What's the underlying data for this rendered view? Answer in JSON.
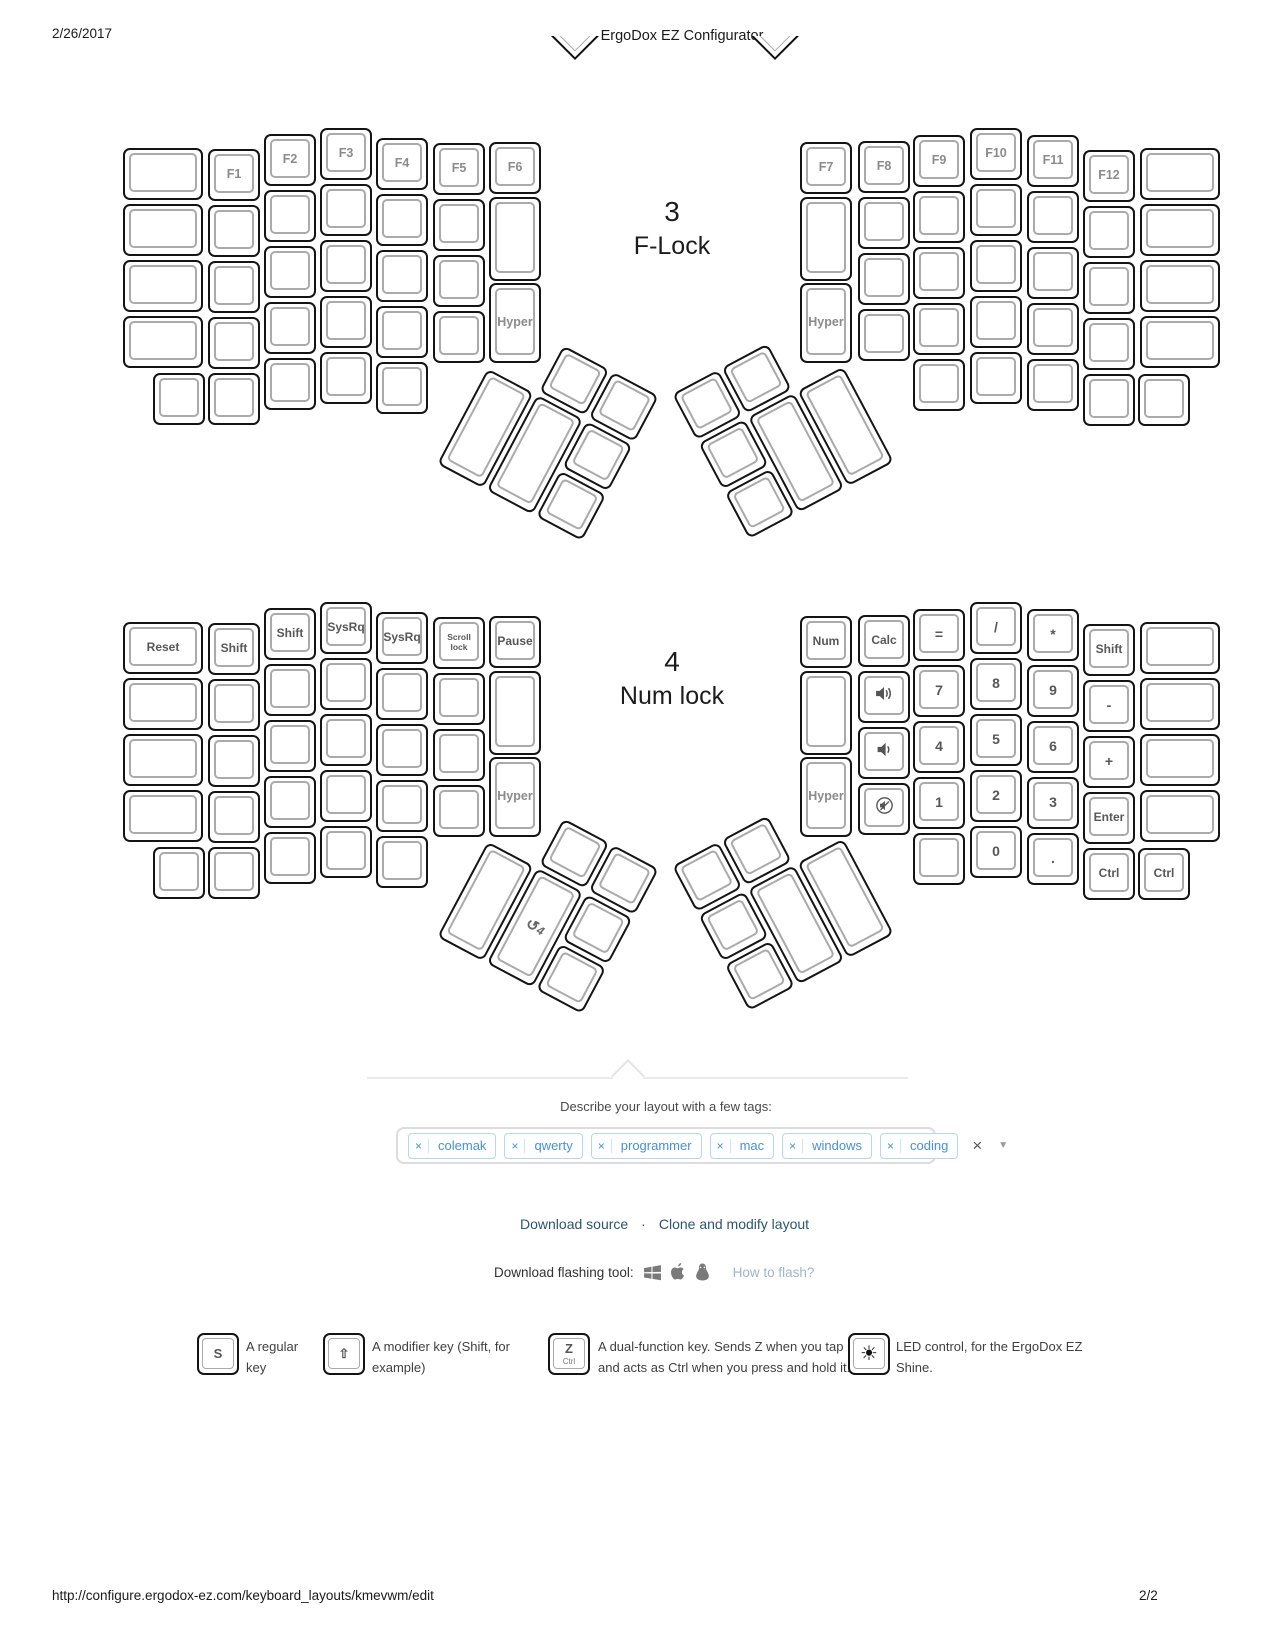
{
  "page": {
    "header_date": "2/26/2017",
    "header_title": "ErgoDox EZ Configurator",
    "footer_url": "http://configure.ergodox-ez.com/keyboard_layouts/kmevwm/edit",
    "footer_page": "2/2"
  },
  "colors": {
    "tag_text": "#4a90d2",
    "tag_border": "#b9d5ef",
    "link": "#2e5570",
    "muted_link": "#9fb5c8",
    "key_border": "#141414",
    "keytop_border": "#aaaaaa",
    "key_label": "#575757"
  },
  "thumb_toggle": {
    "glyph": "↺",
    "number": "4"
  },
  "keyboards": [
    {
      "layer_number": "3",
      "layer_name": "F-Lock",
      "label_x": 672,
      "num_top": 196,
      "name_top": 232,
      "y": 128,
      "halves": [
        {
          "x": 123,
          "cols": [
            {
              "x": 0,
              "w": 80,
              "yo": 20,
              "n": 4,
              "labels": {}
            },
            {
              "x": 85,
              "w": 52,
              "yo": 21,
              "n": 5,
              "labels": {
                "0": "F1"
              }
            },
            {
              "x": 141,
              "w": 52,
              "yo": 6,
              "n": 5,
              "labels": {
                "0": "F2"
              }
            },
            {
              "x": 197,
              "w": 52,
              "yo": 0,
              "n": 5,
              "labels": {
                "0": "F3"
              }
            },
            {
              "x": 253,
              "w": 52,
              "yo": 10,
              "n": 5,
              "labels": {
                "0": "F4"
              }
            },
            {
              "x": 310,
              "w": 52,
              "yo": 15,
              "n": 4,
              "labels": {
                "0": "F5"
              }
            },
            {
              "x": 366,
              "w": 52,
              "yo": 14,
              "inner": true,
              "labels": {
                "0": "F6",
                "2": "Hyper"
              }
            }
          ],
          "extra": [
            {
              "x": 30,
              "yo": 21,
              "row": 4,
              "label": ""
            }
          ],
          "thumb": {
            "cx": 548,
            "cy": 430,
            "rot": 28,
            "mirror": false,
            "labels": {}
          }
        },
        {
          "x": 800,
          "cols": [
            {
              "x": 0,
              "w": 52,
              "yo": 14,
              "inner": true,
              "labels": {
                "0": "F7",
                "2": "Hyper"
              }
            },
            {
              "x": 58,
              "w": 52,
              "yo": 13,
              "n": 4,
              "labels": {
                "0": "F8"
              }
            },
            {
              "x": 113,
              "w": 52,
              "yo": 7,
              "n": 5,
              "labels": {
                "0": "F9"
              }
            },
            {
              "x": 170,
              "w": 52,
              "yo": 0,
              "n": 5,
              "labels": {
                "0": "F10"
              }
            },
            {
              "x": 227,
              "w": 52,
              "yo": 7,
              "n": 5,
              "labels": {
                "0": "F11"
              }
            },
            {
              "x": 283,
              "w": 52,
              "yo": 22,
              "n": 5,
              "labels": {
                "0": "F12"
              }
            },
            {
              "x": 340,
              "w": 80,
              "yo": 20,
              "n": 4,
              "labels": {}
            }
          ],
          "extra": [
            {
              "x": 338,
              "yo": 22,
              "row": 4,
              "label": ""
            }
          ],
          "thumb": {
            "cx": 783,
            "cy": 428,
            "rot": -28,
            "mirror": true,
            "labels": {}
          }
        }
      ]
    },
    {
      "layer_number": "4",
      "layer_name": "Num lock",
      "label_x": 672,
      "num_top": 646,
      "name_top": 682,
      "y": 602,
      "halves": [
        {
          "x": 123,
          "cols": [
            {
              "x": 0,
              "w": 80,
              "yo": 20,
              "n": 4,
              "labels": {
                "0": "Reset"
              }
            },
            {
              "x": 85,
              "w": 52,
              "yo": 21,
              "n": 5,
              "labels": {
                "0": "Shift"
              }
            },
            {
              "x": 141,
              "w": 52,
              "yo": 6,
              "n": 5,
              "labels": {
                "0": "Shift"
              }
            },
            {
              "x": 197,
              "w": 52,
              "yo": 0,
              "n": 5,
              "labels": {
                "0": "SysRq"
              }
            },
            {
              "x": 253,
              "w": 52,
              "yo": 10,
              "n": 5,
              "labels": {
                "0": "SysRq"
              }
            },
            {
              "x": 310,
              "w": 52,
              "yo": 15,
              "n": 4,
              "labels": {
                "0": "Scroll\nlock"
              }
            },
            {
              "x": 366,
              "w": 52,
              "yo": 14,
              "inner": true,
              "labels": {
                "0": "Pause",
                "2": "Hyper"
              }
            }
          ],
          "extra": [
            {
              "x": 30,
              "yo": 21,
              "row": 4,
              "label": ""
            }
          ],
          "thumb": {
            "cx": 548,
            "cy": 903,
            "rot": 28,
            "mirror": false,
            "labels": {
              "b2": "@layer4"
            }
          }
        },
        {
          "x": 800,
          "cols": [
            {
              "x": 0,
              "w": 52,
              "yo": 14,
              "inner": true,
              "labels": {
                "0": "Num",
                "2": "Hyper"
              }
            },
            {
              "x": 58,
              "w": 52,
              "yo": 13,
              "n": 4,
              "labels": {
                "0": "Calc",
                "1": "@volume-up",
                "2": "@volume-down",
                "3": "@mute"
              }
            },
            {
              "x": 113,
              "w": 52,
              "yo": 7,
              "n": 5,
              "labels": {
                "0": "=",
                "1": "7",
                "2": "4",
                "3": "1"
              }
            },
            {
              "x": 170,
              "w": 52,
              "yo": 0,
              "n": 5,
              "labels": {
                "0": "/",
                "1": "8",
                "2": "5",
                "3": "2",
                "4": "0"
              }
            },
            {
              "x": 227,
              "w": 52,
              "yo": 7,
              "n": 5,
              "labels": {
                "0": "*",
                "1": "9",
                "2": "6",
                "3": "3",
                "4": "."
              }
            },
            {
              "x": 283,
              "w": 52,
              "yo": 22,
              "n": 5,
              "labels": {
                "0": "Shift",
                "1": "-",
                "2": "+",
                "3": "Enter",
                "4": "Ctrl"
              }
            },
            {
              "x": 340,
              "w": 80,
              "yo": 20,
              "n": 4,
              "labels": {}
            }
          ],
          "extra": [
            {
              "x": 338,
              "yo": 22,
              "row": 4,
              "label": "Ctrl"
            }
          ],
          "thumb": {
            "cx": 783,
            "cy": 900,
            "rot": -28,
            "mirror": true,
            "labels": {}
          }
        }
      ]
    }
  ],
  "tags": {
    "prompt": "Describe your layout with a few tags:",
    "items": [
      "colemak",
      "qwerty",
      "programmer",
      "mac",
      "windows",
      "coding"
    ],
    "remove_icon": "×",
    "clear_icon": "×",
    "dropdown_icon": "▼"
  },
  "links": {
    "download_source": "Download source",
    "separator": "·",
    "clone": "Clone and modify layout"
  },
  "flash": {
    "label": "Download flashing tool:",
    "how_to_flash": "How to flash?",
    "icons": [
      "windows-icon",
      "apple-icon",
      "linux-icon"
    ]
  },
  "legend": [
    {
      "cap": "S",
      "cap_x": 197,
      "text_x": 246,
      "lines": [
        "A regular",
        "key"
      ]
    },
    {
      "cap": "⇧",
      "cap_x": 323,
      "text_x": 372,
      "lines": [
        "A modifier key (Shift, for",
        "example)"
      ]
    },
    {
      "cap": "Z",
      "cap_sub": "Ctrl",
      "cap_x": 548,
      "text_x": 598,
      "lines": [
        "A dual-function key. Sends Z when you tap it,",
        "and acts as Ctrl when you press and hold it."
      ]
    },
    {
      "cap": "☀",
      "cap_led": true,
      "cap_x": 848,
      "text_x": 896,
      "lines": [
        "LED control, for the ErgoDox EZ",
        "Shine."
      ]
    }
  ]
}
